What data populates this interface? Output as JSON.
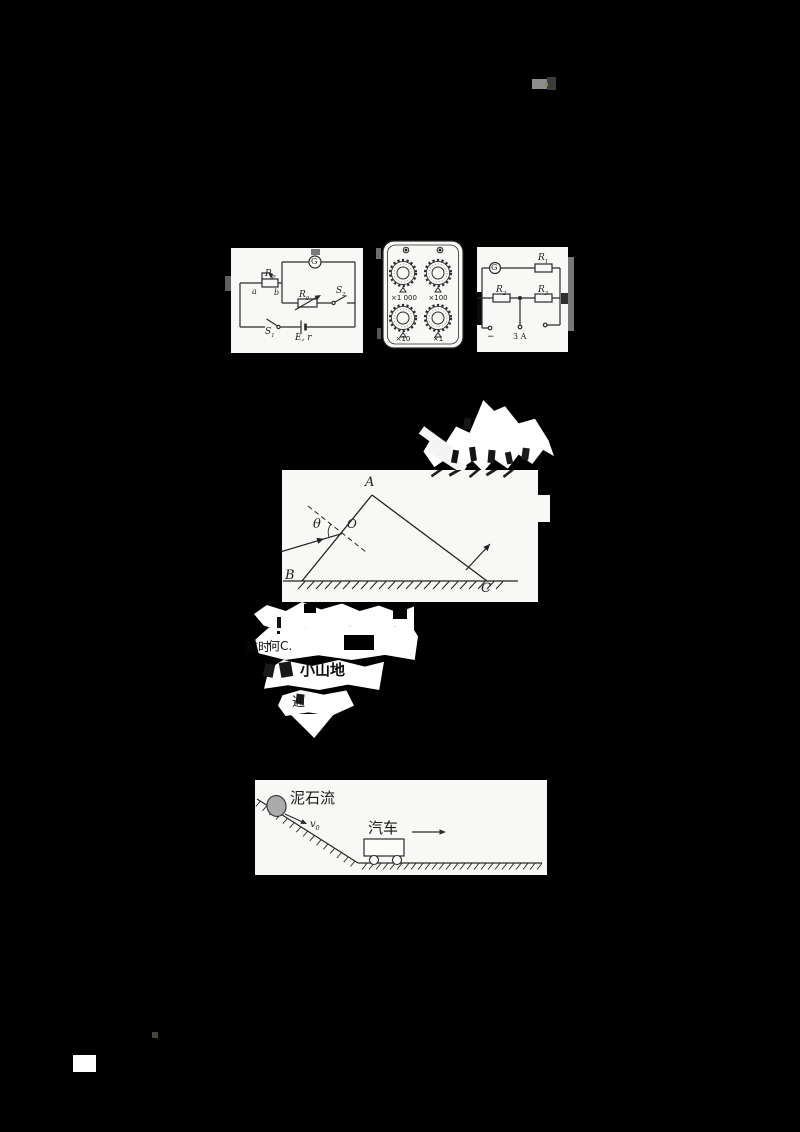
{
  "background": "#000000",
  "ink": "#2b2b2b",
  "panel_color": "#f8f8f6",
  "figures": {
    "halfDeflectionCircuit": {
      "galvanometer": "G",
      "rp": {
        "base": "R",
        "sub": "P"
      },
      "terminalA": "a",
      "terminalB": "b",
      "r0": {
        "base": "R",
        "sub": "0"
      },
      "s2": {
        "base": "S",
        "sub": "2"
      },
      "s1": {
        "base": "S",
        "sub": "1"
      },
      "battery": "E, r"
    },
    "resistanceBox": {
      "dials": [
        "×1 000",
        "×100",
        "×10",
        "×1"
      ]
    },
    "meterCircuit": {
      "galvanometer": "G",
      "r1": {
        "base": "R",
        "sub": "1"
      },
      "r2": {
        "base": "R",
        "sub": "2"
      },
      "r3": {
        "base": "R",
        "sub": "3"
      },
      "negTerminal": "−",
      "currentTerminal": "3 A"
    },
    "prism": {
      "apex": "A",
      "left": "B",
      "right": "C",
      "point": "O",
      "angle": "θ"
    },
    "slope": {
      "debrisFlow": "泥石流",
      "v0": {
        "base": "v",
        "sub": "0"
      },
      "car": "汽车"
    }
  },
  "fragments": {
    "row1a": "前时",
    "row1b": "何C.",
    "row2": "小山地",
    "row3": "通"
  }
}
